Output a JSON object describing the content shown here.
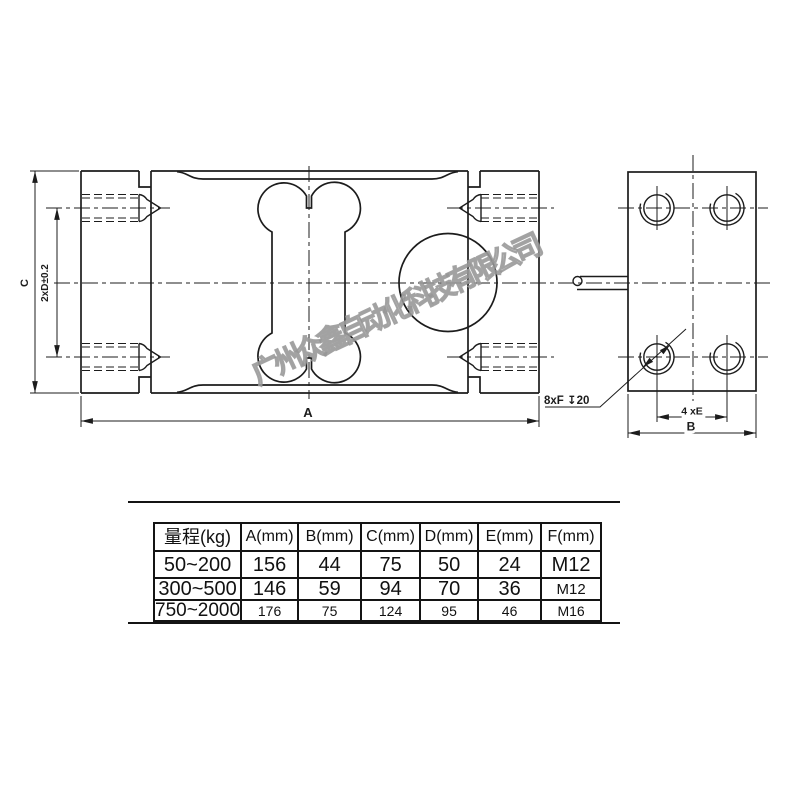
{
  "watermark": "广州众鑫自动化科技有限公司",
  "colors": {
    "line": "#1c1c1c",
    "watermark": "#b0b0b0"
  },
  "labels": {
    "dim_a": "A",
    "dim_b": "B",
    "dim_c": "C",
    "dim_2xd": "2xD±0.2",
    "dim_4xe": "4 xE",
    "thread_callout": "8xF ↧20"
  },
  "table": {
    "headers": [
      "量程(kg)",
      "A(mm)",
      "B(mm)",
      "C(mm)",
      "D(mm)",
      "E(mm)",
      "F(mm)"
    ],
    "rows": [
      [
        "50~200",
        "156",
        "44",
        "75",
        "50",
        "24",
        "M12"
      ],
      [
        "300~500",
        "146",
        "59",
        "94",
        "70",
        "36",
        "M12"
      ],
      [
        "750~2000",
        "176",
        "75",
        "124",
        "95",
        "46",
        "M16"
      ]
    ]
  }
}
